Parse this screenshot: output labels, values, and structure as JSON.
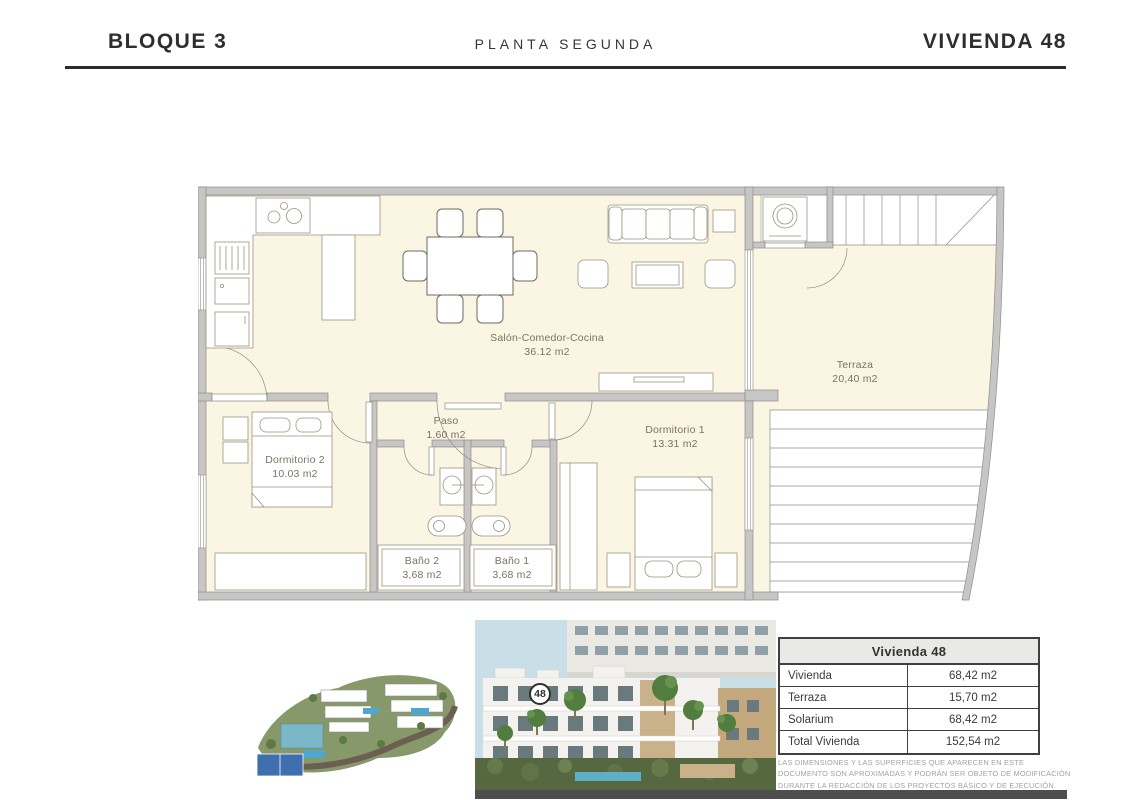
{
  "header": {
    "left": "BLOQUE 3",
    "center": "PLANTA SEGUNDA",
    "right": "VIVIENDA 48"
  },
  "floor_plan": {
    "rooms": [
      {
        "label": "Salón-Comedor-Cocina",
        "area": "36.12 m2"
      },
      {
        "label": "Paso",
        "area": "1.60 m2"
      },
      {
        "label": "Dormitorio 1",
        "area": "13.31 m2"
      },
      {
        "label": "Dormitorio 2",
        "area": "10.03 m2"
      },
      {
        "label": "Baño 2",
        "area": "3,68 m2"
      },
      {
        "label": "Baño 1",
        "area": "3,68 m2"
      },
      {
        "label": "Terraza",
        "area": "20,40 m2"
      }
    ]
  },
  "unit_badge": "48",
  "summary_table": {
    "title": "Vivienda 48",
    "rows": [
      {
        "label": "Vivienda",
        "value": "68,42 m2"
      },
      {
        "label": "Terraza",
        "value": "15,70 m2"
      },
      {
        "label": "Solarium",
        "value": "68,42 m2"
      },
      {
        "label": "Total Vivienda",
        "value": "152,54 m2"
      }
    ]
  },
  "disclaimer": "LAS DIMENSIONES Y LAS SUPERFICIES QUE APARECEN EN ESTE DOCUMENTO SON APROXIMADAS Y PODRÁN SER OBJETO DE MODIFICACIÓN DURANTE LA REDACCIÓN DE LOS PROYECTOS BÁSICO Y DE EJECUCIÓN.",
  "colors": {
    "wall_gray": "#c7c6c4",
    "floor_cream": "#fbf5e4",
    "furniture_line": "#9a9383",
    "header_dark": "#2d2e32",
    "pool_blue": "#4fa8cc",
    "palm_green": "#517d3f"
  }
}
